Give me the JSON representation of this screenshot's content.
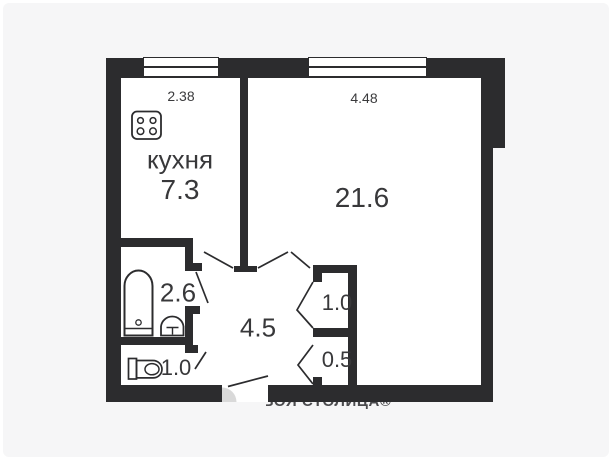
{
  "page": {
    "background_color": "#f6f6f7",
    "floor_color": "#ffffff",
    "wall_color": "#2c2c2e",
    "text_color": "#38383a",
    "watermark_color": "#4b4b4e",
    "door_arc_color": "#d9d9d9"
  },
  "plan_type": "apartment-floor-plan",
  "rooms": {
    "kitchen": {
      "label": "кухня",
      "area": "7.3",
      "top_dimension": "2.38"
    },
    "living": {
      "area": "21.6",
      "top_dimension": "4.48"
    },
    "bathroom": {
      "area": "2.6"
    },
    "toilet": {
      "area": "1.0"
    },
    "hallway": {
      "area": "4.5"
    },
    "closet_upper": {
      "area": "1.0"
    },
    "closet_lower": {
      "area": "0.5"
    }
  },
  "watermark": {
    "text": "ТВОЯ СТОЛИЦА®"
  },
  "icons": {
    "stove": "stove-icon",
    "bathtub": "bathtub-icon",
    "sink": "sink-icon",
    "toilet": "toilet-icon",
    "window": "window-symbol",
    "door_swing": "door-swing-line",
    "entry_door_arc": "entry-door-arc"
  }
}
